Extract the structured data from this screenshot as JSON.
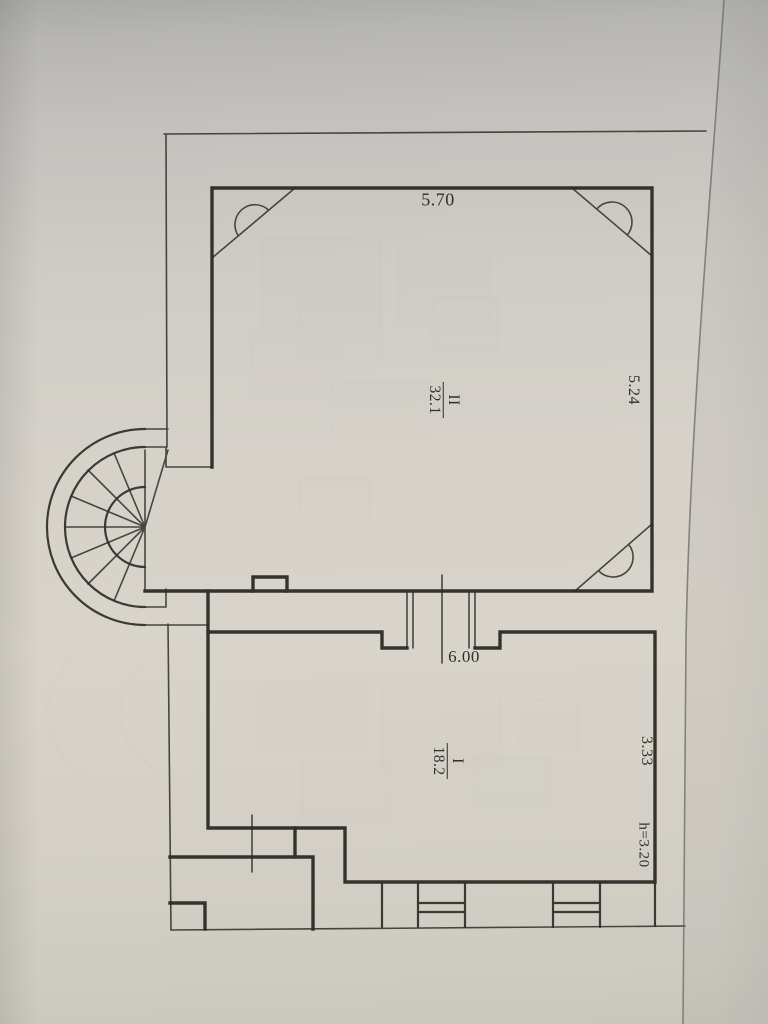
{
  "plan": {
    "rooms": [
      {
        "number": "II",
        "area": "32.1"
      },
      {
        "number": "I",
        "area": "18.2"
      }
    ],
    "dimensions": {
      "top_width": "5.70",
      "right_height_upper": "5.24",
      "middle_width": "6.00",
      "right_height_lower": "3.33",
      "ceiling_height": "h=3.20"
    },
    "colors": {
      "paper": "#d6d2ca",
      "paper_top_shade": "#a9a9a7",
      "ink": "#33332e",
      "fold_shade": "#c6c4be"
    }
  }
}
